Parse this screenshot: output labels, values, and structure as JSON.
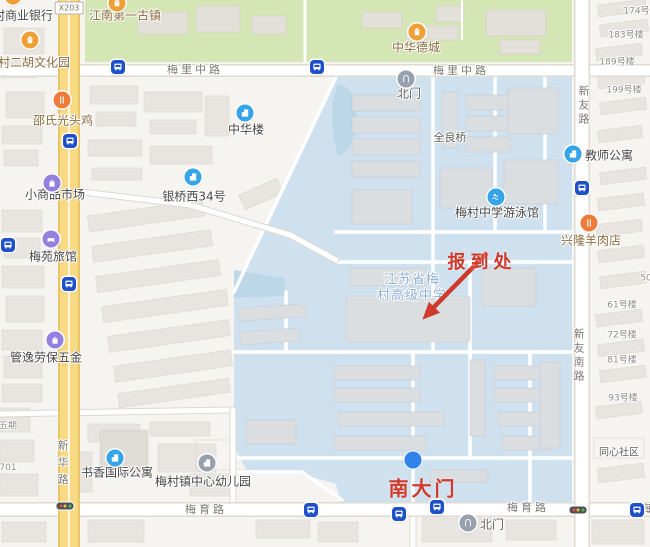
{
  "map": {
    "colors": {
      "highlight_red": "#cf3a2c",
      "campus_blue": "#cfe0ee",
      "marker_blue": "#2f83e8",
      "road_yellow": "#f8da85"
    },
    "annotations": {
      "registration": "报到处",
      "south_gate": "南大门"
    },
    "school_label": {
      "line1": "江苏省梅",
      "line2": "村高级中学"
    },
    "roads": {
      "x203": "X203",
      "meili_1": "梅里中路",
      "meili_2": "梅里中路",
      "meiyu_1": "梅育路",
      "meiyu_2": "梅育路",
      "meiyu_3": "梅",
      "xinyou": "新友路",
      "xinyou_south": "新友南路",
      "xinhua": "新华路"
    },
    "pois": [
      {
        "label": "江南第一古镇",
        "type": "attraction"
      },
      {
        "label": "中华德城",
        "type": "attraction"
      },
      {
        "label": "梅村二胡文化园",
        "type": "attraction"
      },
      {
        "label": "村商业银行",
        "type": "bank"
      },
      {
        "label": "邵氏光头鸡",
        "type": "food"
      },
      {
        "label": "中华楼",
        "type": "building"
      },
      {
        "label": "小商品市场",
        "type": "shopping"
      },
      {
        "label": "银桥西34号",
        "type": "building"
      },
      {
        "label": "梅苑旅馆",
        "type": "hotel"
      },
      {
        "label": "管逸劳保五金",
        "type": "shopping"
      },
      {
        "label": "梅村中学游泳馆",
        "type": "swimming"
      },
      {
        "label": "教师公寓",
        "type": "building"
      },
      {
        "label": "兴隆羊肉店",
        "type": "food"
      },
      {
        "label": "书香国际公寓",
        "type": "building"
      },
      {
        "label": "梅村镇中心幼儿园",
        "type": "kindergarten"
      },
      {
        "label": "北门",
        "type": "gate"
      },
      {
        "label": "北门",
        "type": "gate"
      },
      {
        "label": "全良桥",
        "type": "bridge"
      },
      {
        "label": "同心社区",
        "type": "community"
      }
    ],
    "unit_labels": [
      "174号楼",
      "183号楼",
      "189号楼",
      "199号楼",
      "50号楼",
      "61号楼",
      "72号楼",
      "81号楼",
      "93号楼"
    ],
    "partial_labels": {
      "wuqi": "五期",
      "num701": "701"
    }
  }
}
